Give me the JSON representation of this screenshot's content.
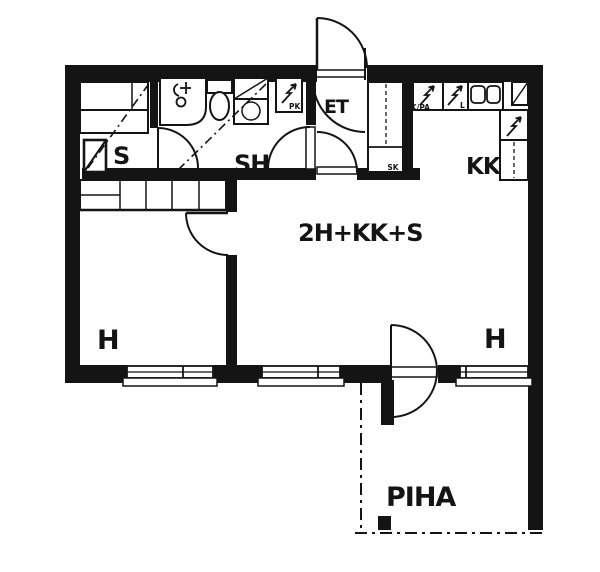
{
  "plan": {
    "apartment_type": "2H+KK+S",
    "rooms": {
      "sauna": "S",
      "shower_room": "SH",
      "entry_hall": "ET",
      "kitchenette": "KK",
      "cleaning_closet": "SK",
      "left_room": "H",
      "right_room": "H",
      "yard": "PIHA"
    },
    "appliances": {
      "fridge_freezer": "JK/PA",
      "stove": "L",
      "washing_machine": "PK"
    },
    "colors": {
      "ink": "#141414",
      "paper": "#ffffff"
    }
  }
}
